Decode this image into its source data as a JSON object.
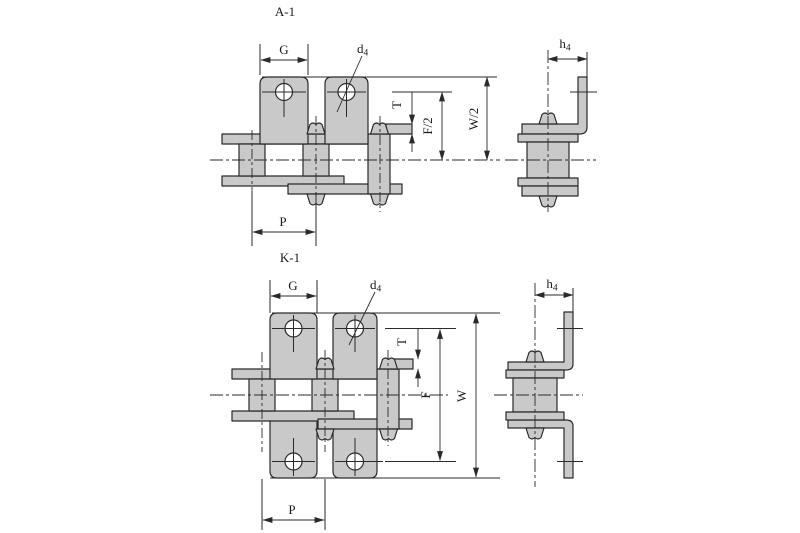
{
  "drawing": {
    "background_color": "#ffffff",
    "line_color": "#2a2a2a",
    "part_fill_color": "#c9c9c9"
  },
  "a1": {
    "title": "A-1",
    "dims": {
      "g": "G",
      "d_main": "d",
      "d_sub": "4",
      "t": "T",
      "f_half": "F/2",
      "w_half": "W/2",
      "p": "P",
      "h_main": "h",
      "h_sub": "4"
    }
  },
  "k1": {
    "title": "K-1",
    "dims": {
      "g": "G",
      "d_main": "d",
      "d_sub": "4",
      "t": "T",
      "f": "F",
      "w": "W",
      "p": "P",
      "h_main": "h",
      "h_sub": "4"
    }
  }
}
